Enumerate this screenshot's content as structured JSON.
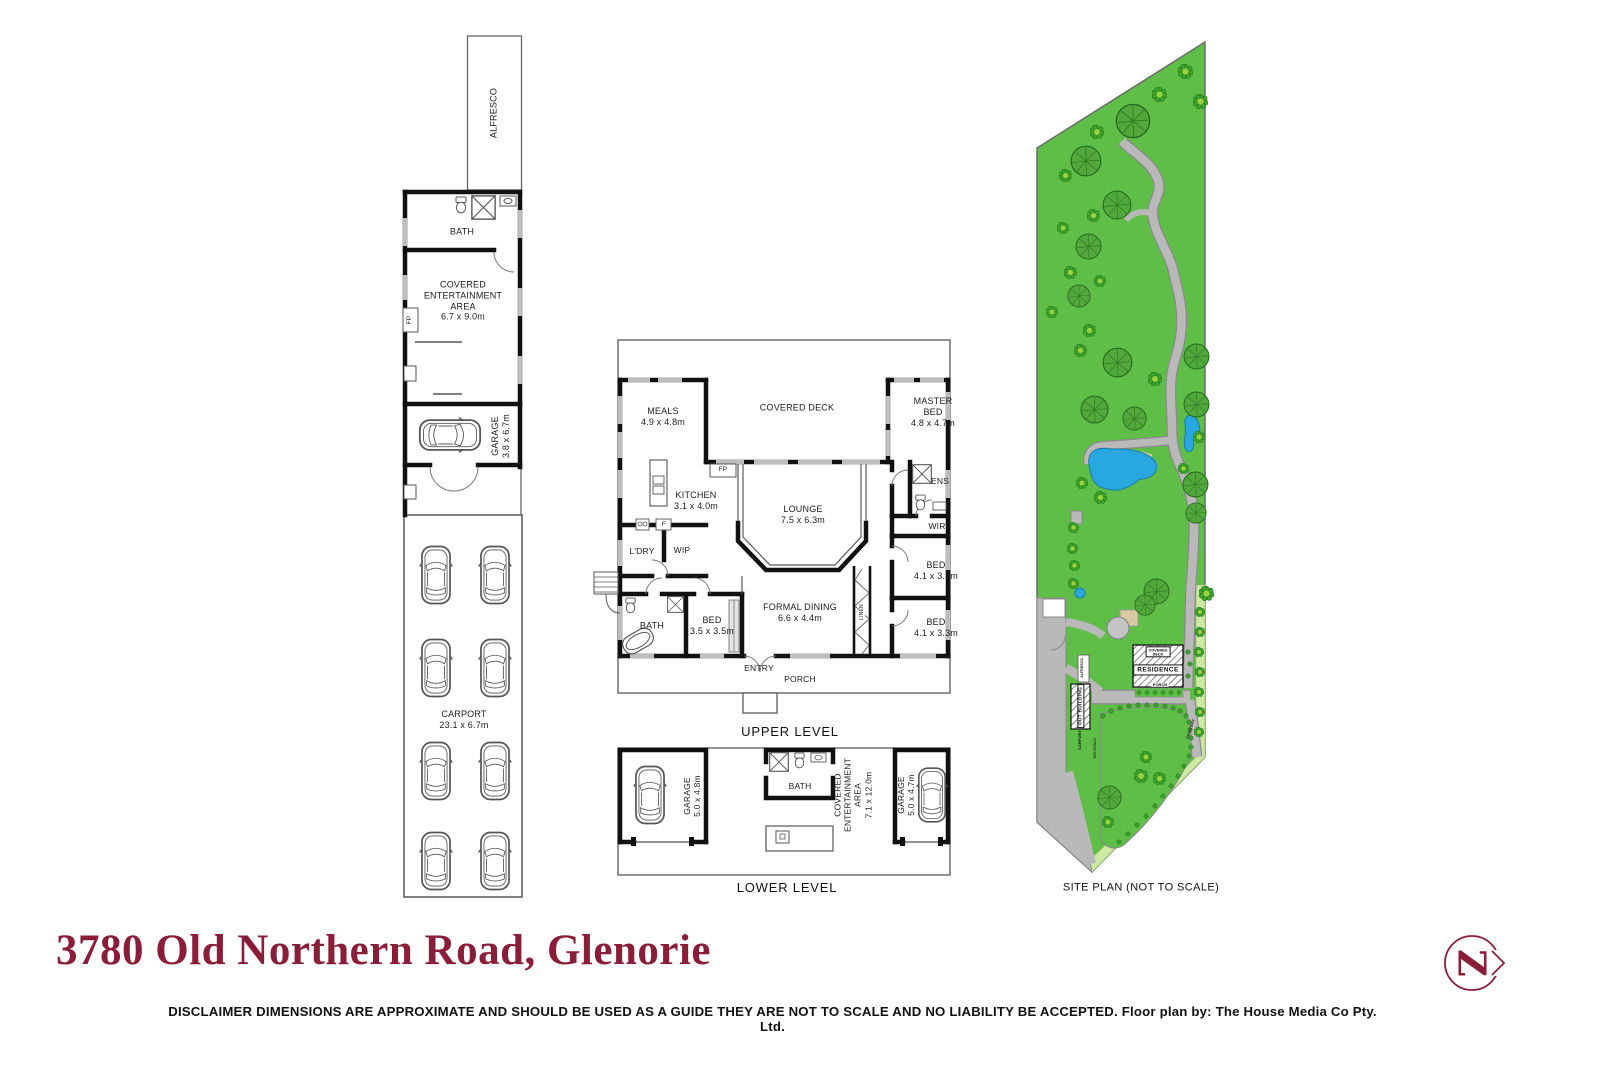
{
  "left_plan": {
    "alfresco": "ALFRESCO",
    "bath": "BATH",
    "cea": "COVERED\nENTERTAINMENT\nAREA\n6.7 x 9.0m",
    "fp": "FP",
    "garage": "GARAGE\n3.8 x 6.7m",
    "carport": "CARPORT\n23.1 x 6.7m"
  },
  "upper": {
    "caption": "UPPER LEVEL",
    "meals": "MEALS\n4.9 x 4.8m",
    "deck": "COVERED DECK",
    "master": "MASTER\nBED\n4.8 x 4.7m",
    "kitchen": "KITCHEN\n3.1 x 4.0m",
    "fp": "FP",
    "f": "F",
    "lounge": "LOUNGE\n7.5 x 6.3m",
    "ens": "ENS",
    "wir": "WIR",
    "ldry": "L'DRY",
    "wip": "WIP",
    "bed1": "BED\n4.1 x 3.3m",
    "bed2": "BED\n4.1 x 3.3m",
    "bath": "BATH",
    "bed3": "BED\n3.5 x 3.5m",
    "dining": "FORMAL DINING\n6.6 x 4.4m",
    "entry": "ENTRY",
    "porch": "PORCH",
    "linen": "LINEN"
  },
  "lower": {
    "caption": "LOWER LEVEL",
    "garage_l": "GARAGE\n5.0 x 4.8m",
    "bath": "BATH",
    "cea": "COVERED\nENTERTAINMENT\nAREA\n7.1 x 12.0m",
    "garage_r": "GARAGE\n5.0 x 4.7m"
  },
  "site": {
    "caption": "SITE PLAN (NOT TO SCALE)",
    "residence": "RESIDENCE",
    "covered_deck": "COVERED\nDECK",
    "porch": "PORCH",
    "out_building": "OUT BUILDING",
    "alfresco": "ALFRESCO",
    "carport": "CARPORT",
    "driveway1": "DRIVEWAY",
    "driveway2": "DRIVEWAY"
  },
  "footer": {
    "title": "3780 Old Northern Road, Glenorie",
    "disclaimer": "DISCLAIMER DIMENSIONS ARE APPROXIMATE AND SHOULD BE USED AS A GUIDE THEY ARE NOT TO SCALE AND NO LIABILITY BE ACCEPTED. ",
    "credit": "Floor plan by: The House Media Co Pty. Ltd."
  },
  "logo": {
    "letter": "Z"
  },
  "colors": {
    "title_maroon": "#8a1e38",
    "grass": "#5fbe48",
    "tree": "#52a83b",
    "bush": "#3fa42d",
    "water": "#29a8e0",
    "driveway": "#b9b9b9",
    "wall": "#111111"
  }
}
